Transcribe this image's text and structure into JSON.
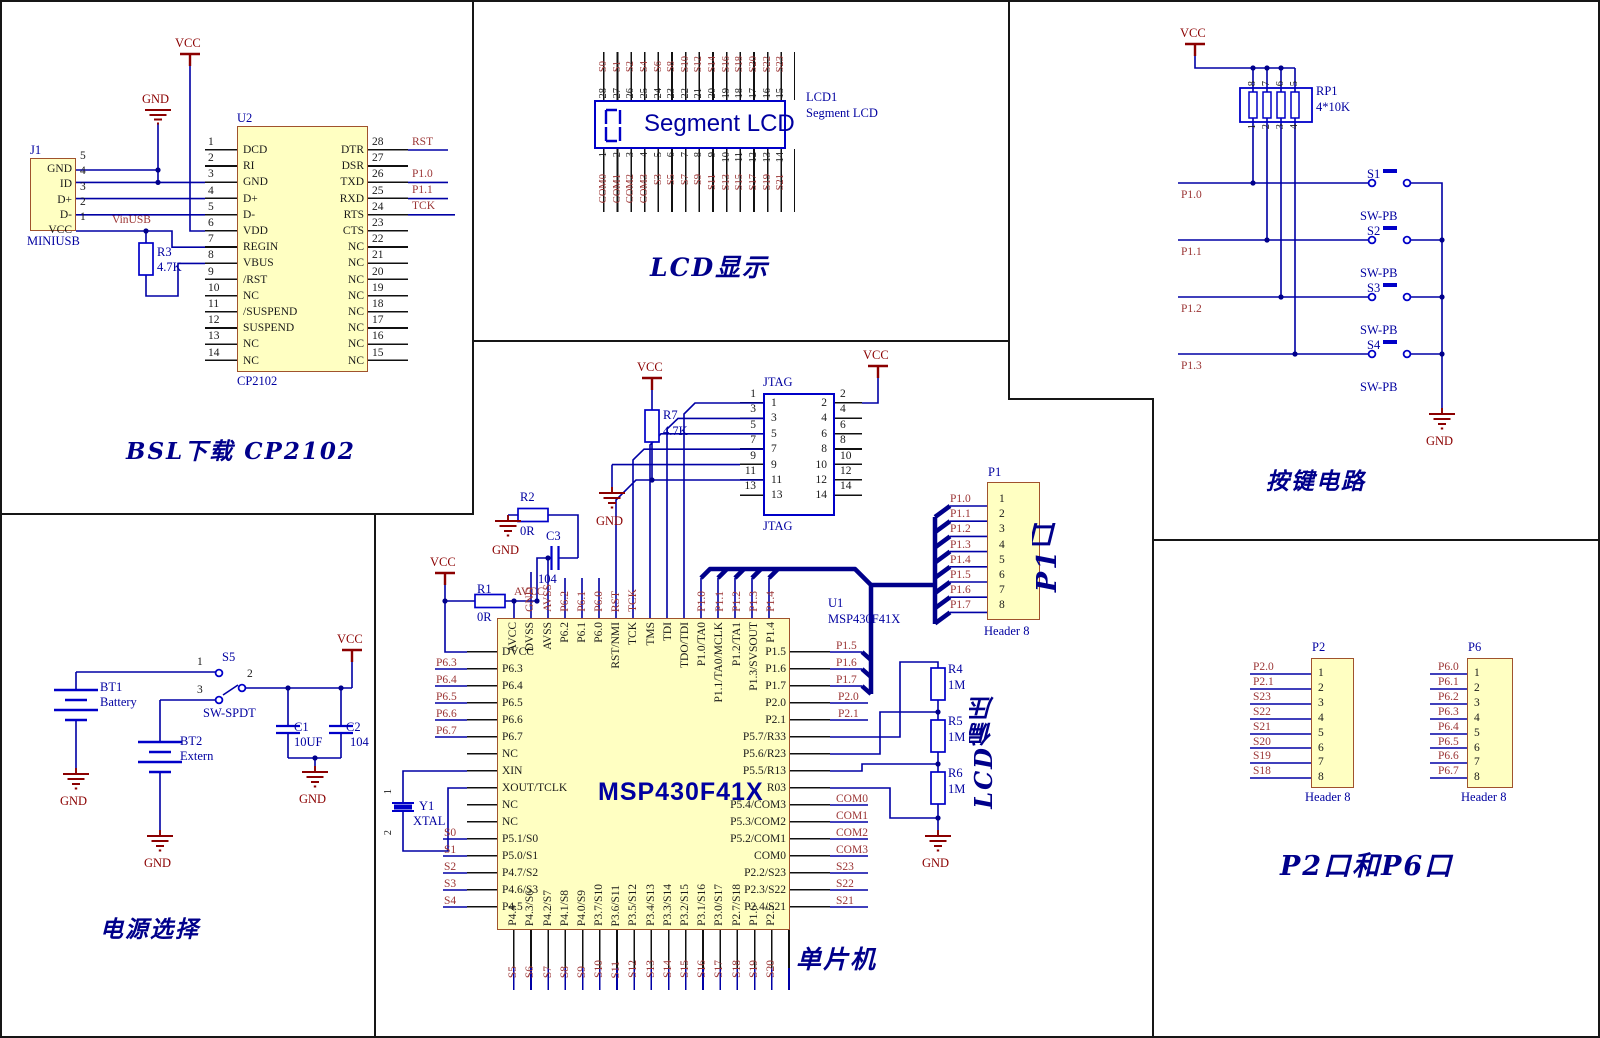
{
  "bsl": {
    "title": "BSL下载 CP2102",
    "vcc": "VCC",
    "gnd": "GND",
    "vinusb": "VinUSB",
    "j1": {
      "ref": "J1",
      "footer": "MINIUSB",
      "numbers": [
        "5",
        "4",
        "3",
        "2",
        "1"
      ],
      "names": [
        "GND",
        "ID",
        "D+",
        "D-",
        "VCC"
      ]
    },
    "r3": {
      "ref": "R3",
      "value": "4.7K"
    },
    "u2": {
      "ref": "U2",
      "part": "CP2102",
      "left_numbers": [
        "1",
        "2",
        "3",
        "4",
        "5",
        "6",
        "7",
        "8",
        "9",
        "10",
        "11",
        "12",
        "13",
        "14"
      ],
      "left_names": [
        "DCD",
        "RI",
        "GND",
        "D+",
        "D-",
        "VDD",
        "REGIN",
        "VBUS",
        "/RST",
        "NC",
        "/SUSPEND",
        "SUSPEND",
        "NC",
        "NC"
      ],
      "right_numbers": [
        "28",
        "27",
        "26",
        "25",
        "24",
        "23",
        "22",
        "21",
        "20",
        "19",
        "18",
        "17",
        "16",
        "15"
      ],
      "right_names": [
        "DTR",
        "DSR",
        "TXD",
        "RXD",
        "RTS",
        "CTS",
        "NC",
        "NC",
        "NC",
        "NC",
        "NC",
        "NC",
        "NC",
        "NC"
      ],
      "nets": {
        "rst": "RST",
        "p10": "P1.0",
        "p11": "P1.1",
        "tck": "TCK"
      }
    }
  },
  "lcd": {
    "title": "LCD显示",
    "ref": "LCD1",
    "type": "Segment LCD",
    "display": "Segment LCD",
    "top": [
      {
        "n": "28",
        "s": "S0"
      },
      {
        "n": "27",
        "s": "S1"
      },
      {
        "n": "26",
        "s": "S2"
      },
      {
        "n": "25",
        "s": "S4"
      },
      {
        "n": "24",
        "s": "S6"
      },
      {
        "n": "23",
        "s": "S8"
      },
      {
        "n": "22",
        "s": "S10"
      },
      {
        "n": "21",
        "s": "S12"
      },
      {
        "n": "20",
        "s": "S14"
      },
      {
        "n": "19",
        "s": "S16"
      },
      {
        "n": "18",
        "s": "S18"
      },
      {
        "n": "17",
        "s": "S20"
      },
      {
        "n": "16",
        "s": "S22"
      },
      {
        "n": "15",
        "s": "S23"
      }
    ],
    "bottom": [
      {
        "n": "1",
        "s": "COM0"
      },
      {
        "n": "2",
        "s": "COM1"
      },
      {
        "n": "3",
        "s": "COM2"
      },
      {
        "n": "4",
        "s": "COM3"
      },
      {
        "n": "5",
        "s": "S3"
      },
      {
        "n": "6",
        "s": "S5"
      },
      {
        "n": "7",
        "s": "S7"
      },
      {
        "n": "8",
        "s": "S9"
      },
      {
        "n": "9",
        "s": "S11"
      },
      {
        "n": "10",
        "s": "S13"
      },
      {
        "n": "11",
        "s": "S15"
      },
      {
        "n": "12",
        "s": "S17"
      },
      {
        "n": "13",
        "s": "S19"
      },
      {
        "n": "14",
        "s": "S21"
      }
    ]
  },
  "keys": {
    "title": "按键电路",
    "vcc": "VCC",
    "gnd": "GND",
    "rp1": {
      "ref": "RP1",
      "value": "4*10K",
      "top_pins": [
        "8",
        "7",
        "6",
        "5"
      ],
      "bottom_pins": [
        "1",
        "2",
        "3",
        "4"
      ]
    },
    "nets": [
      "P1.0",
      "P1.1",
      "P1.2",
      "P1.3"
    ],
    "switches": [
      "S1",
      "S2",
      "S3",
      "S4"
    ],
    "switch_types": [
      "SW-PB",
      "SW-PB",
      "SW-PB",
      "SW-PB"
    ]
  },
  "power": {
    "title": "电源选择",
    "vcc": "VCC",
    "gnd": "GND",
    "bt1": {
      "ref": "BT1",
      "name": "Battery"
    },
    "bt2": {
      "ref": "BT2",
      "name": "Extern"
    },
    "s5": {
      "ref": "S5",
      "type": "SW-SPDT",
      "pin1": "1",
      "pin2": "2",
      "pin3": "3"
    },
    "c1": {
      "ref": "C1",
      "value": "10UF"
    },
    "c2": {
      "ref": "C2",
      "value": "104"
    }
  },
  "mcu": {
    "title": "单片机",
    "vcc": "VCC",
    "gnd": "GND",
    "net_avcc": "AVCC",
    "u1": {
      "ref": "U1",
      "part": "MSP430F41X",
      "big": "MSP430F41X"
    },
    "pins_left": [
      "DVCC",
      "P6.3",
      "P6.4",
      "P6.5",
      "P6.6",
      "P6.7",
      "NC",
      "XIN",
      "XOUT/TCLK",
      "NC",
      "NC",
      "P5.1/S0",
      "P5.0/S1",
      "P4.7/S2",
      "P4.6/S3",
      "P4.5"
    ],
    "pins_right": [
      "P1.5",
      "P1.6",
      "P1.7",
      "P2.0",
      "P2.1",
      "P5.7/R33",
      "P5.6/R23",
      "P5.5/R13",
      "R03",
      "P5.4/COM3",
      "P5.3/COM2",
      "P5.2/COM1",
      "COM0",
      "P2.2/S23",
      "P2.3/S22",
      "P2.4/S21"
    ],
    "pins_top": [
      "AVCC",
      "DVSS",
      "AVSS",
      "P6.2",
      "P6.1",
      "P6.0",
      "RST/NMI",
      "TCK",
      "TMS",
      "TDI",
      "TDO/TDI",
      "P1.0/TA0",
      "P1.1/TA0/MCLK",
      "P1.2/TA1",
      "P1.3/SVSOUT",
      "P1.4"
    ],
    "pins_bottom": [
      "P4.4",
      "P4.3/S6",
      "P4.2/S7",
      "P4.1/S8",
      "P4.0/S9",
      "P3.7/S10",
      "P3.6/S11",
      "P3.5/S12",
      "P3.4/S13",
      "P3.3/S14",
      "P3.2/S15",
      "P3.1/S16",
      "P3.0/S17",
      "P2.7/S18",
      "P1.6",
      "P2.5"
    ],
    "nets_top": [
      "GND",
      "AVSS",
      "P6.2",
      "P6.1",
      "P6.0",
      "RST",
      "TCK"
    ],
    "nets_p1_top": [
      "P1.0",
      "P1.1",
      "P1.2",
      "P1.3",
      "P1.4"
    ],
    "nets_left_p6": [
      "P6.3",
      "P6.4",
      "P6.5",
      "P6.6",
      "P6.7"
    ],
    "nets_left_s": [
      "S0",
      "S1",
      "S2",
      "S3",
      "S4"
    ],
    "nets_bottom": [
      "S5",
      "S6",
      "S7",
      "S8",
      "S9",
      "S10",
      "S11",
      "S12",
      "S13",
      "S14",
      "S15",
      "S16",
      "S17",
      "S18",
      "S19",
      "S20"
    ],
    "nets_right_p1": [
      "P1.5",
      "P1.6",
      "P1.7"
    ],
    "nets_right_p2": [
      "P2.0",
      "P2.1"
    ],
    "nets_right_com": [
      "COM0",
      "COM1",
      "COM2",
      "COM3",
      "S23",
      "S22",
      "S21"
    ],
    "r1": {
      "ref": "R1",
      "value": "0R"
    },
    "r2": {
      "ref": "R2",
      "value": "0R"
    },
    "c3": {
      "ref": "C3",
      "value": "104"
    },
    "r7": {
      "ref": "R7",
      "value": "4.7K"
    },
    "y1": {
      "ref": "Y1",
      "type": "XTAL",
      "pin1": "1",
      "pin2": "2"
    },
    "jtag": {
      "label_top": "JTAG",
      "label_bottom": "JTAG",
      "left_inner": [
        "1",
        "3",
        "5",
        "7",
        "9",
        "11",
        "13"
      ],
      "right_inner": [
        "2",
        "4",
        "6",
        "8",
        "10",
        "12",
        "14"
      ],
      "left_outer": [
        "1",
        "3",
        "5",
        "7",
        "9",
        "11",
        "13"
      ],
      "right_outer": [
        "2",
        "4",
        "6",
        "8",
        "10",
        "12",
        "14"
      ]
    },
    "p1": {
      "ref": "P1",
      "type": "Header 8",
      "title": "P1口",
      "numbers": [
        "1",
        "2",
        "3",
        "4",
        "5",
        "6",
        "7",
        "8"
      ],
      "nets": [
        "P1.0",
        "P1.1",
        "P1.2",
        "P1.3",
        "P1.4",
        "P1.5",
        "P1.6",
        "P1.7"
      ]
    },
    "bias": {
      "title": "LCD偏压",
      "r4": {
        "ref": "R4",
        "value": "1M"
      },
      "r5": {
        "ref": "R5",
        "value": "1M"
      },
      "r6": {
        "ref": "R6",
        "value": "1M"
      }
    }
  },
  "ports": {
    "title": "P2口和P6口",
    "p2": {
      "ref": "P2",
      "type": "Header 8",
      "numbers": [
        "1",
        "2",
        "3",
        "4",
        "5",
        "6",
        "7",
        "8"
      ],
      "nets": [
        "P2.0",
        "P2.1",
        "S23",
        "S22",
        "S21",
        "S20",
        "S19",
        "S18"
      ]
    },
    "p6": {
      "ref": "P6",
      "type": "Header 8",
      "numbers": [
        "1",
        "2",
        "3",
        "4",
        "5",
        "6",
        "7",
        "8"
      ],
      "nets": [
        "P6.0",
        "P6.1",
        "P6.2",
        "P6.3",
        "P6.4",
        "P6.5",
        "P6.6",
        "P6.7"
      ]
    }
  },
  "colors": {
    "wire_blue": "#0000A5",
    "bus_blue": "#00008B",
    "component_blue": "#0000C8",
    "power_red": "#8B0000",
    "net_red": "#9B3434",
    "part_fill": "#FFFFC2",
    "border_black": "#161616"
  }
}
